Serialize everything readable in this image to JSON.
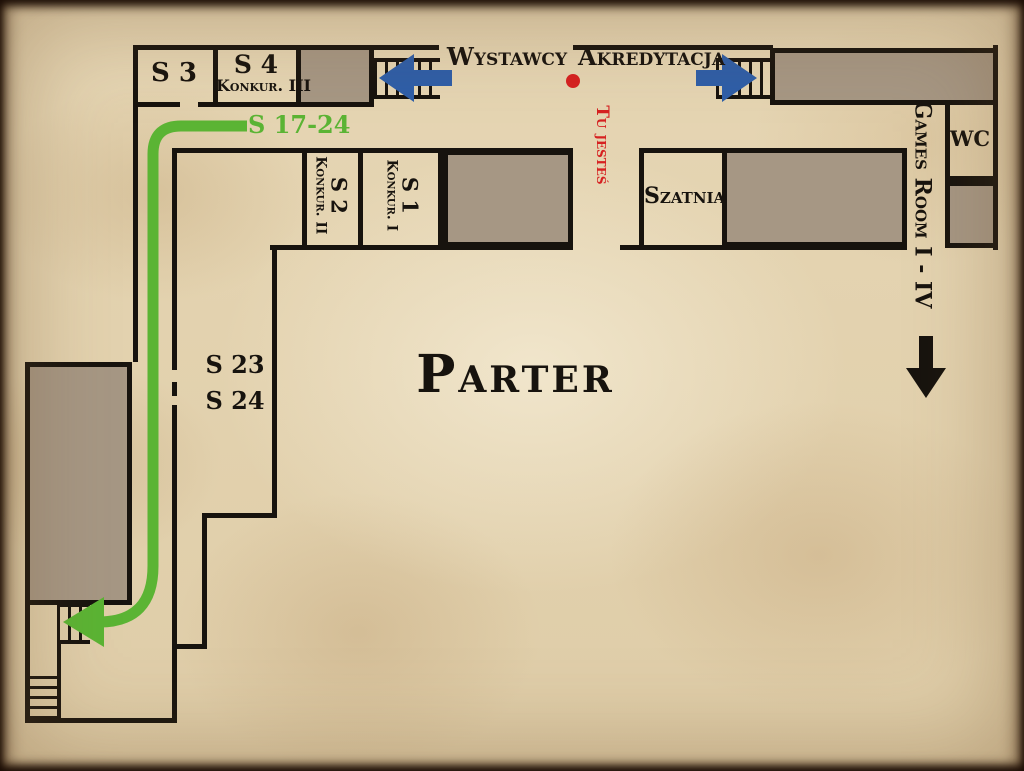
{
  "floor_plan": {
    "title": "Parter",
    "rooms": {
      "s3": {
        "label": "S 3"
      },
      "s4": {
        "label": "S 4",
        "sublabel": "Konkur. III"
      },
      "s2": {
        "label": "S 2",
        "sublabel": "Konkur. II"
      },
      "s1": {
        "label": "S 1",
        "sublabel": "Konkur. I"
      },
      "szatnia": {
        "label": "Szatnia"
      },
      "wc": {
        "label": "WC"
      },
      "s23": {
        "label": "S 23"
      },
      "s24": {
        "label": "S 24"
      }
    },
    "annotations": {
      "wystawcy": "Wystawcy",
      "akredytacja": "Akredytacja",
      "you_are_here": "Tu jesteś",
      "games_room": "Games Room I - IV",
      "route_label": "S 17-24"
    },
    "colors": {
      "wall": "#17130e",
      "room_fill": "#a69784",
      "route_green": "#5bb434",
      "arrow_blue": "#2e5ea8",
      "marker_red": "#d62121",
      "paper": "#e4d3ae"
    }
  }
}
